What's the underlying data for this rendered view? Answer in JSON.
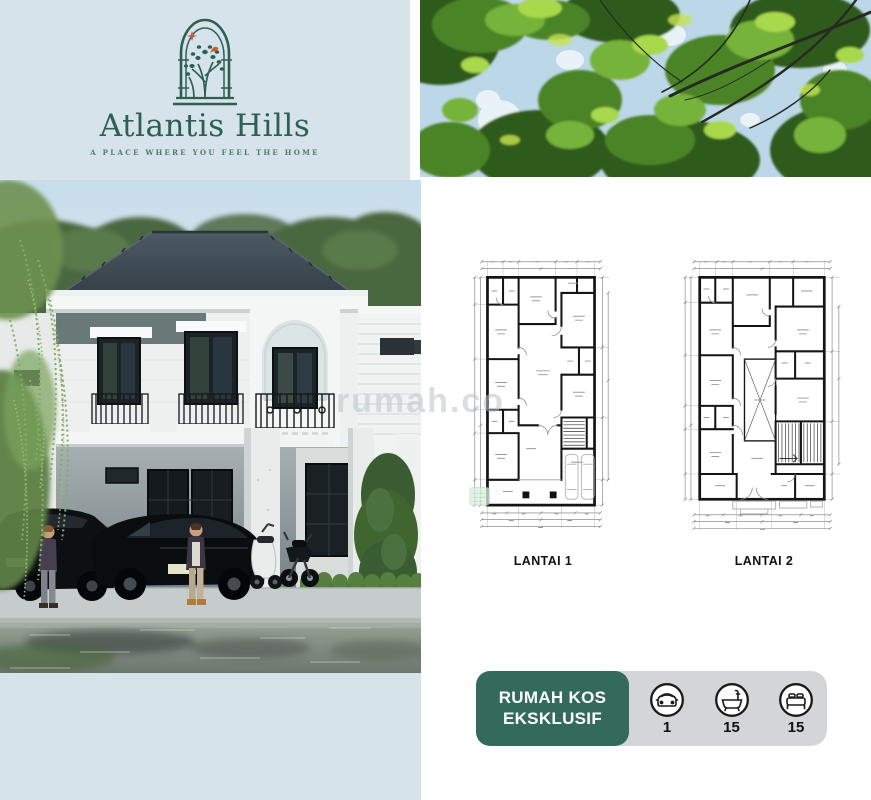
{
  "brand": {
    "title": "Atlantis Hills",
    "tagline": "A PLACE WHERE YOU FEEL THE HOME"
  },
  "plans": {
    "plan1_label": "LANTAI 1",
    "plan2_label": "LANTAI 2"
  },
  "badge": {
    "line1": "RUMAH KOS",
    "line2": "EKSKLUSIF",
    "features": [
      {
        "icon": "car-icon",
        "value": "1"
      },
      {
        "icon": "bathtub-icon",
        "value": "15"
      },
      {
        "icon": "bed-icon",
        "value": "15"
      }
    ]
  },
  "watermark": {
    "text": "rumah.co"
  },
  "colors": {
    "page_bg": "#d7e3ea",
    "panel_bg": "#ffffff",
    "logo_teal": "#2c6052",
    "accent_red": "#c75b39",
    "badge_teal": "#336a5c",
    "badge_gray": "#d3d5d7",
    "plan_line": "#151515"
  }
}
